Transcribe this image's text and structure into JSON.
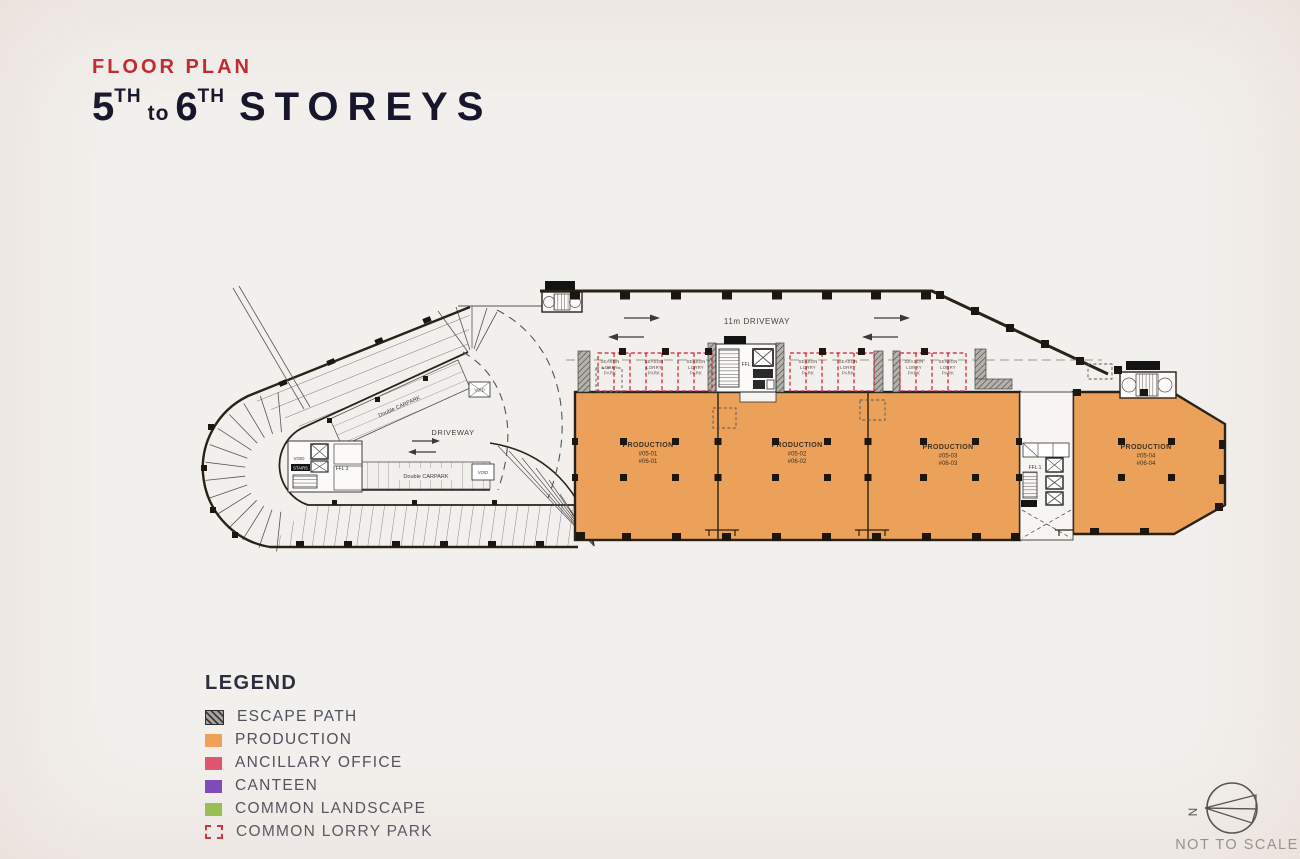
{
  "header": {
    "kicker": "FLOOR PLAN",
    "storey_from": "5",
    "sup": "TH",
    "connector": "to",
    "storey_to": "6",
    "title": "STOREYS"
  },
  "plan": {
    "driveway_main_label": "11m DRIVEWAY",
    "driveway_loop_label": "DRIVEWAY",
    "double_carpark_label": "Double CARPARK",
    "void_label": "VOID",
    "ffl1": "FFL 1",
    "ffl2": "FFL 2",
    "ffl3": "FFL 3",
    "stair_label": "STAIRS",
    "lorry": {
      "l1": "SEASON",
      "l2": "LORRY",
      "l3": "PARK"
    },
    "units": [
      {
        "name": "PRODUCTION",
        "level5": "#05-01",
        "level6": "#06-01"
      },
      {
        "name": "PRODUCTION",
        "level5": "#05-02",
        "level6": "#06-02"
      },
      {
        "name": "PRODUCTION",
        "level5": "#05-03",
        "level6": "#06-03"
      },
      {
        "name": "PRODUCTION",
        "level5": "#05-04",
        "level6": "#06-04"
      }
    ],
    "colors": {
      "production": "#eba159",
      "lorry_dash": "#cf1f2d",
      "outline": "#2a2117"
    }
  },
  "legend": {
    "title": "LEGEND",
    "items": [
      {
        "label": "ESCAPE PATH",
        "type": "hatch",
        "color": "#a8a49e"
      },
      {
        "label": "PRODUCTION",
        "type": "solid",
        "color": "#f0a159"
      },
      {
        "label": "ANCILLARY OFFICE",
        "type": "solid",
        "color": "#e05570"
      },
      {
        "label": "CANTEEN",
        "type": "solid",
        "color": "#7c48bc"
      },
      {
        "label": "COMMON LANDSCAPE",
        "type": "solid",
        "color": "#93c050"
      },
      {
        "label": "COMMON LORRY PARK",
        "type": "dashed",
        "color": "#cc2b33"
      }
    ]
  },
  "compass": {
    "north": "N",
    "note": "NOT TO SCALE"
  }
}
